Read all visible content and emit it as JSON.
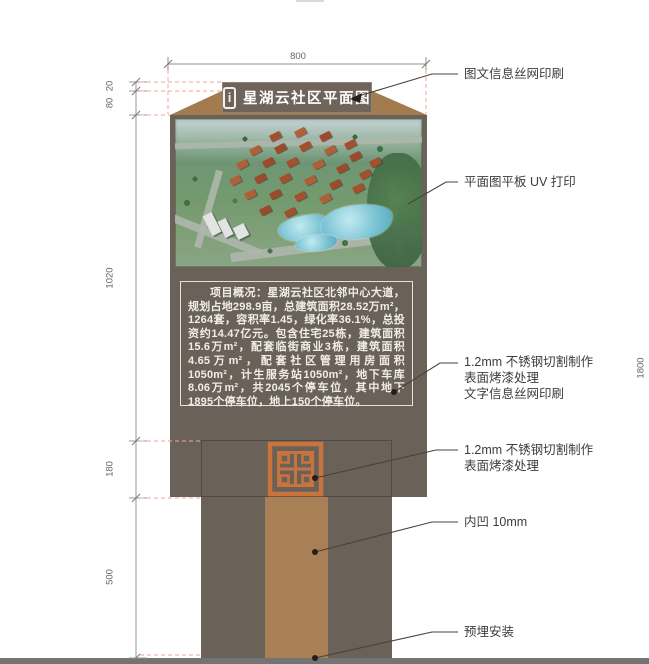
{
  "sign": {
    "info_icon_glyph": "i",
    "title": "星湖云社区平面图",
    "description": "项目概况：星湖云社区北邻中心大道，规划占地298.9亩，总建筑面积28.52万m²，1264套，容积率1.45，绿化率36.1%，总投资约14.47亿元。包含住宅25栋，建筑面积15.6万m²，配套临街商业3栋，建筑面积4.65万m²，配套社区管理用房面积1050m²，计生服务站1050m²，地下车库8.06万m²，共2045个停车位，其中地下1895个停车位，地上150个停车位。"
  },
  "dimensions": {
    "top": "800",
    "left": [
      "20",
      "80",
      "1020",
      "180",
      "500"
    ],
    "right": "1800"
  },
  "annotations": [
    {
      "lines": [
        "图文信息丝网印刷"
      ]
    },
    {
      "lines": [
        "平面图平板 UV 打印"
      ]
    },
    {
      "lines": [
        "1.2mm 不锈钢切割制作",
        "表面烤漆处理",
        "文字信息丝网印刷"
      ]
    },
    {
      "lines": [
        "1.2mm 不锈钢切割制作",
        "表面烤漆处理"
      ]
    },
    {
      "lines": [
        "内凹 10mm"
      ]
    },
    {
      "lines": [
        "预埋安装"
      ]
    }
  ],
  "colors": {
    "panel_gray": "#6a6159",
    "cap_wood": "#a27b4e",
    "lattice_orange": "#c9743c",
    "pedestal_tan": "#a97f55",
    "ground_gray": "#737373",
    "construction_dash": "#f0a79c"
  }
}
